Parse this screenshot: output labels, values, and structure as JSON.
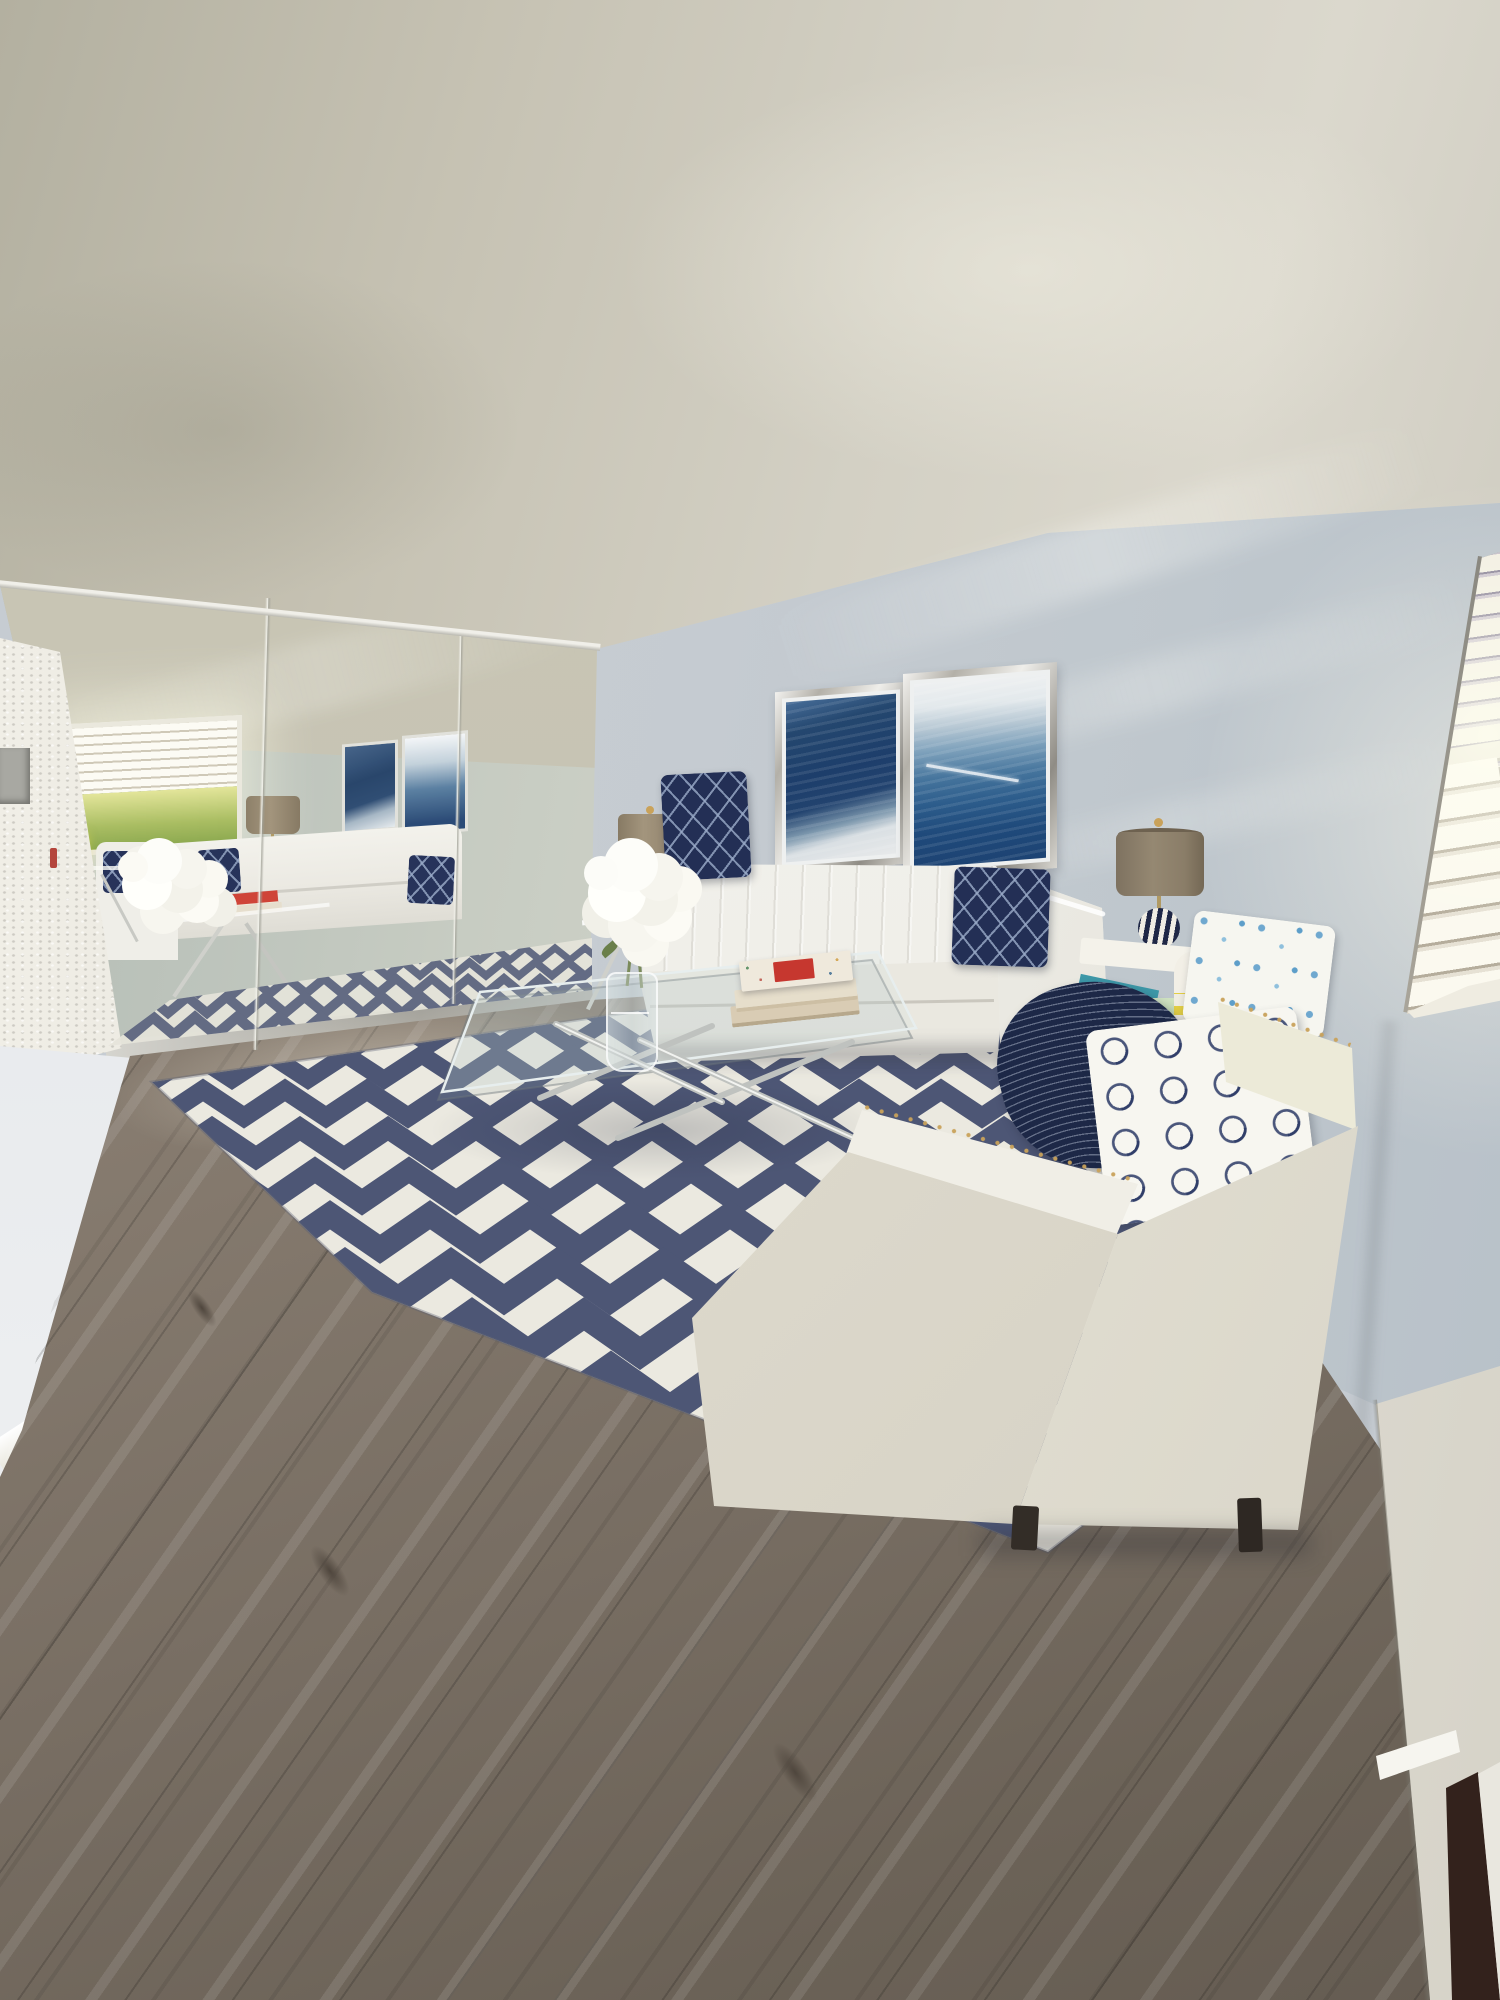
{
  "meta": {
    "type": "photograph",
    "description": "Virtually staged living room: white channel-tufted sofa and cream nailhead armchair with navy accent pillows, navy-and-white chevron area rug, floor-to-ceiling mirrored closet wall reflecting a bright window, two blue abstract artworks in silver frames, taupe drum table lamps, glass coffee table with chrome X base, gray-brown wood-look plank floor, and a window with open white blinds on the right.",
    "width_px": 1500,
    "height_px": 2000
  },
  "palette": {
    "ceiling": "#cbc7b9",
    "back_wall": "#c5cbd1",
    "right_wall": "#bcc4cb",
    "mirror_tint": "#bdc4bb",
    "floor_wood": "#857a6e",
    "rug_navy": "#4d5675",
    "rug_cream": "#ebe9e0",
    "sofa_white": "#f2f1ec",
    "chair_cream": "#e6e3d8",
    "pillow_navy": "#24305a",
    "nailhead_gold": "#c9a25a",
    "art_blue": "#1f4678",
    "lamp_shade_taupe": "#94876f",
    "blinds_white": "#f6f3e7",
    "door_gap_brown": "#33221c",
    "outdoor_green": "#a9bd62",
    "candle_yellow": "#ecd83a",
    "book_red": "#c6372f",
    "book_teal": "#3d98a8",
    "cup_green": "#b9d4ac",
    "vase_stripe_yellow": "#e3cf45"
  },
  "walls": {
    "back": {
      "color": "#c5cbd1",
      "light_rays": true
    },
    "right": {
      "color": "#bcc4cb",
      "corner_shadow": true
    },
    "left_hallway": {
      "color": "#e7eaec",
      "baseboard": "#f0efe9"
    }
  },
  "mirror_wall": {
    "panel_count": 3,
    "seam_positions_x": [
      262,
      458
    ],
    "track": "metallic bottom track",
    "reflections": [
      "window with open blinds and green landscape",
      "two blue abstract artworks",
      "white sofa with navy lattice pillows",
      "armchair with blue grid pillow",
      "taupe drum table lamp",
      "white hydrangea bouquet",
      "glass side table with red-cover book and yellow candle",
      "chevron rug",
      "glass coffee table with chrome legs"
    ]
  },
  "window_right": {
    "blinds": "white horizontal louvers, open",
    "sections": [
      "upper slats",
      "mid rail",
      "lower slats"
    ],
    "sill_color": "#efece1",
    "light": "strong daylight glow"
  },
  "artworks": [
    {
      "position": "left",
      "frame": "polished silver",
      "style": "abstract navy field with pale base",
      "colors": [
        "#1d3e6b",
        "#e7e9ea"
      ]
    },
    {
      "position": "right",
      "frame": "polished silver",
      "style": "abstract wave, pale top to deep blue with white diagonal streak",
      "colors": [
        "#eef0f1",
        "#1d4373"
      ]
    }
  ],
  "sofa": {
    "color": "#f2f1ec",
    "style": "channel-tufted back, track arms",
    "pillows": [
      {
        "position": "left",
        "pattern": "navy diamond lattice"
      },
      {
        "position": "right",
        "pattern": "navy diamond lattice"
      }
    ]
  },
  "armchair": {
    "color": "#e6e3d8",
    "trim": "gold nailhead rows on arm edges",
    "feet": "dark wood",
    "textiles": [
      "navy throw with fine white curved lines",
      "white pillow with blue floral-snowflake print",
      "white pillow with navy quatrefoil trellis",
      "navy lattice pillow",
      "second white-blue floral pillow"
    ]
  },
  "coffee_table": {
    "top": "rectangular glass",
    "base": "chrome X legs",
    "items": [
      "stack of three coffee-table books, red artwork on top cover",
      "white hydrangea bouquet in clear glass vase"
    ]
  },
  "side_tables": [
    {
      "position": "left of sofa",
      "top": "glass",
      "base": "chrome X",
      "items": [
        "taupe drum lamp with patterned gourd base"
      ]
    },
    {
      "position": "right of sofa",
      "color": "white",
      "items": [
        "taupe drum lamp with navy striped sphere base",
        "teal books",
        "green celadon cup",
        "white vase with yellow stripes",
        "small orange pot"
      ]
    }
  ],
  "rug": {
    "pattern": "chevron zigzag",
    "colors": {
      "navy": "#4d5675",
      "cream": "#ebe9e0"
    }
  },
  "rug_render": {
    "x0": 80,
    "x1": 1340,
    "y_top": 1004,
    "rows": 13,
    "wave0": 64,
    "wave_grow": 6,
    "amp0": 10,
    "amp_grow": 1.2,
    "gap0": 30,
    "gap_grow": 3.2,
    "stroke0": 14,
    "stroke_grow": 1.7
  },
  "mirror_rug_render": {
    "x0": 90,
    "x1": 610,
    "y_top": 954,
    "rows": 5,
    "wave0": 30,
    "wave_grow": 3,
    "amp0": 6,
    "amp_grow": 0.7,
    "gap0": 15,
    "gap_grow": 2,
    "stroke0": 7,
    "stroke_grow": 0.9
  },
  "floor": {
    "material": "wood-look plank",
    "tone": "gray-brown",
    "direction": "diagonal"
  },
  "door_trim_bottom_right": {
    "color": "#eceae2",
    "gap_color": "#33221c"
  }
}
